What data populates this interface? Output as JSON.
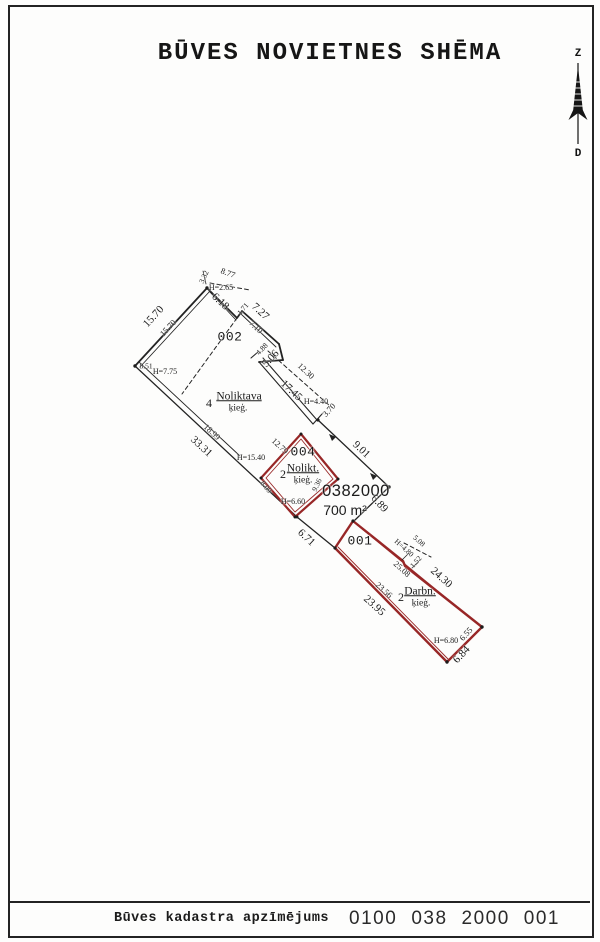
{
  "page": {
    "title": "BŪVES NOVIETNES SHĒMA"
  },
  "compass": {
    "north_label": "Z",
    "south_label": "D"
  },
  "footer": {
    "label": "Būves kadastra apzīmējums",
    "code_groups": [
      "0100",
      "038",
      "2000",
      "001"
    ]
  },
  "colors": {
    "line_black": "#232323",
    "building_red": "#982727",
    "paper": "#fdfdfc"
  },
  "plan": {
    "lot": {
      "cadastral_number": "0382000",
      "area": "700 m²"
    },
    "buildings": [
      {
        "id": "002",
        "floors": "4",
        "name": "Noliktava",
        "material": "ķieģ.",
        "heights": [
          "H=2.65",
          "H=7.75"
        ]
      },
      {
        "id": "004",
        "floors": "2",
        "name": "Nolikt.",
        "material": "ķieģ.",
        "heights": [
          "H=6.60",
          "H=15.40"
        ]
      },
      {
        "id": "001",
        "floors": "2",
        "name": "Darbn.",
        "material": "ķieģ.",
        "heights": [
          "H=4.80",
          "H=6.80"
        ]
      }
    ],
    "labels": [
      {
        "t": "3.32",
        "x": 204,
        "y": 277,
        "r": -65,
        "c": "tiny"
      },
      {
        "t": "8.77",
        "x": 228,
        "y": 273,
        "r": 20,
        "c": "dimsm"
      },
      {
        "t": "H=2.65",
        "x": 221,
        "y": 288,
        "r": 0,
        "c": "h"
      },
      {
        "t": "6.18",
        "x": 220,
        "y": 302,
        "r": 43,
        "c": "dim"
      },
      {
        "t": "1.71",
        "x": 243,
        "y": 309,
        "r": -50,
        "c": "tiny"
      },
      {
        "t": "7.27",
        "x": 260,
        "y": 312,
        "r": 43,
        "c": "dim"
      },
      {
        "t": "7.10",
        "x": 256,
        "y": 327,
        "r": 43,
        "c": "dimsm"
      },
      {
        "t": "002",
        "x": 230,
        "y": 337,
        "r": 0,
        "c": "bid"
      },
      {
        "t": "15.70",
        "x": 154,
        "y": 317,
        "r": -47,
        "c": "dim"
      },
      {
        "t": "15.70",
        "x": 168,
        "y": 328,
        "r": -47,
        "c": "dimsm"
      },
      {
        "t": "8.51",
        "x": 146,
        "y": 366,
        "r": 0,
        "c": "tiny"
      },
      {
        "t": "H=7.75",
        "x": 165,
        "y": 372,
        "r": 0,
        "c": "h"
      },
      {
        "t": "4",
        "x": 209,
        "y": 403,
        "r": 0,
        "c": "num"
      },
      {
        "t": "Noliktava",
        "x": 239,
        "y": 397,
        "r": 0,
        "c": "name"
      },
      {
        "t": "ķieģ.",
        "x": 238,
        "y": 409,
        "r": 0,
        "c": "sub"
      },
      {
        "t": "33.31",
        "x": 201,
        "y": 447,
        "r": 43,
        "c": "dim"
      },
      {
        "t": "18.99",
        "x": 212,
        "y": 432,
        "r": 43,
        "c": "dimsm"
      },
      {
        "t": "4.88",
        "x": 262,
        "y": 349,
        "r": -47,
        "c": "tiny"
      },
      {
        "t": "5.06",
        "x": 271,
        "y": 359,
        "r": -47,
        "c": "dim"
      },
      {
        "t": "12.30",
        "x": 306,
        "y": 371,
        "r": 43,
        "c": "dimsm"
      },
      {
        "t": "17.45",
        "x": 291,
        "y": 391,
        "r": 43,
        "c": "dim"
      },
      {
        "t": "H=4.40",
        "x": 316,
        "y": 402,
        "r": 0,
        "c": "h"
      },
      {
        "t": "3.70",
        "x": 329,
        "y": 410,
        "r": -47,
        "c": "dimsm"
      },
      {
        "t": "9.01",
        "x": 361,
        "y": 450,
        "r": 43,
        "c": "dim"
      },
      {
        "t": "H=15.40",
        "x": 251,
        "y": 458,
        "r": 0,
        "c": "h"
      },
      {
        "t": "12.79",
        "x": 280,
        "y": 446,
        "r": 43,
        "c": "dimsm"
      },
      {
        "t": "004",
        "x": 303,
        "y": 452,
        "r": 0,
        "c": "bid"
      },
      {
        "t": "2",
        "x": 283,
        "y": 474,
        "r": 0,
        "c": "num"
      },
      {
        "t": "Nolikt.",
        "x": 303,
        "y": 469,
        "r": 0,
        "c": "name"
      },
      {
        "t": "ķieģ.",
        "x": 303,
        "y": 481,
        "r": 0,
        "c": "sub"
      },
      {
        "t": "9.36",
        "x": 317,
        "y": 485,
        "r": -65,
        "c": "tiny"
      },
      {
        "t": "8.09",
        "x": 266,
        "y": 487,
        "r": 50,
        "c": "tiny"
      },
      {
        "t": "H=6.60",
        "x": 293,
        "y": 502,
        "r": 0,
        "c": "h"
      },
      {
        "t": "0382000",
        "x": 356,
        "y": 491,
        "r": 0,
        "c": "cad"
      },
      {
        "t": "700 m²",
        "x": 345,
        "y": 510,
        "r": 0,
        "c": "area"
      },
      {
        "t": "6.89",
        "x": 379,
        "y": 504,
        "r": 47,
        "c": "dim"
      },
      {
        "t": "6.71",
        "x": 306,
        "y": 538,
        "r": 43,
        "c": "dim"
      },
      {
        "t": "001",
        "x": 360,
        "y": 541,
        "r": 0,
        "c": "bid"
      },
      {
        "t": "5.08",
        "x": 419,
        "y": 541,
        "r": 42,
        "c": "tiny"
      },
      {
        "t": "H=4.80",
        "x": 404,
        "y": 548,
        "r": 42,
        "c": "tiny"
      },
      {
        "t": "1.52",
        "x": 416,
        "y": 562,
        "r": -48,
        "c": "tiny"
      },
      {
        "t": "25.08",
        "x": 402,
        "y": 569,
        "r": 42,
        "c": "dimsm"
      },
      {
        "t": "24.30",
        "x": 441,
        "y": 578,
        "r": 42,
        "c": "dim"
      },
      {
        "t": "23.56",
        "x": 384,
        "y": 590,
        "r": 42,
        "c": "dimsm"
      },
      {
        "t": "23.95",
        "x": 374,
        "y": 606,
        "r": 42,
        "c": "dim"
      },
      {
        "t": "2",
        "x": 401,
        "y": 597,
        "r": 0,
        "c": "num"
      },
      {
        "t": "Darbn.",
        "x": 420,
        "y": 592,
        "r": 0,
        "c": "name"
      },
      {
        "t": "ķieģ.",
        "x": 421,
        "y": 604,
        "r": 0,
        "c": "sub"
      },
      {
        "t": "H=6.80",
        "x": 446,
        "y": 641,
        "r": 0,
        "c": "h"
      },
      {
        "t": "6.55",
        "x": 466,
        "y": 634,
        "r": -47,
        "c": "dimsm"
      },
      {
        "t": "6.84",
        "x": 462,
        "y": 655,
        "r": -47,
        "c": "dim"
      }
    ]
  }
}
